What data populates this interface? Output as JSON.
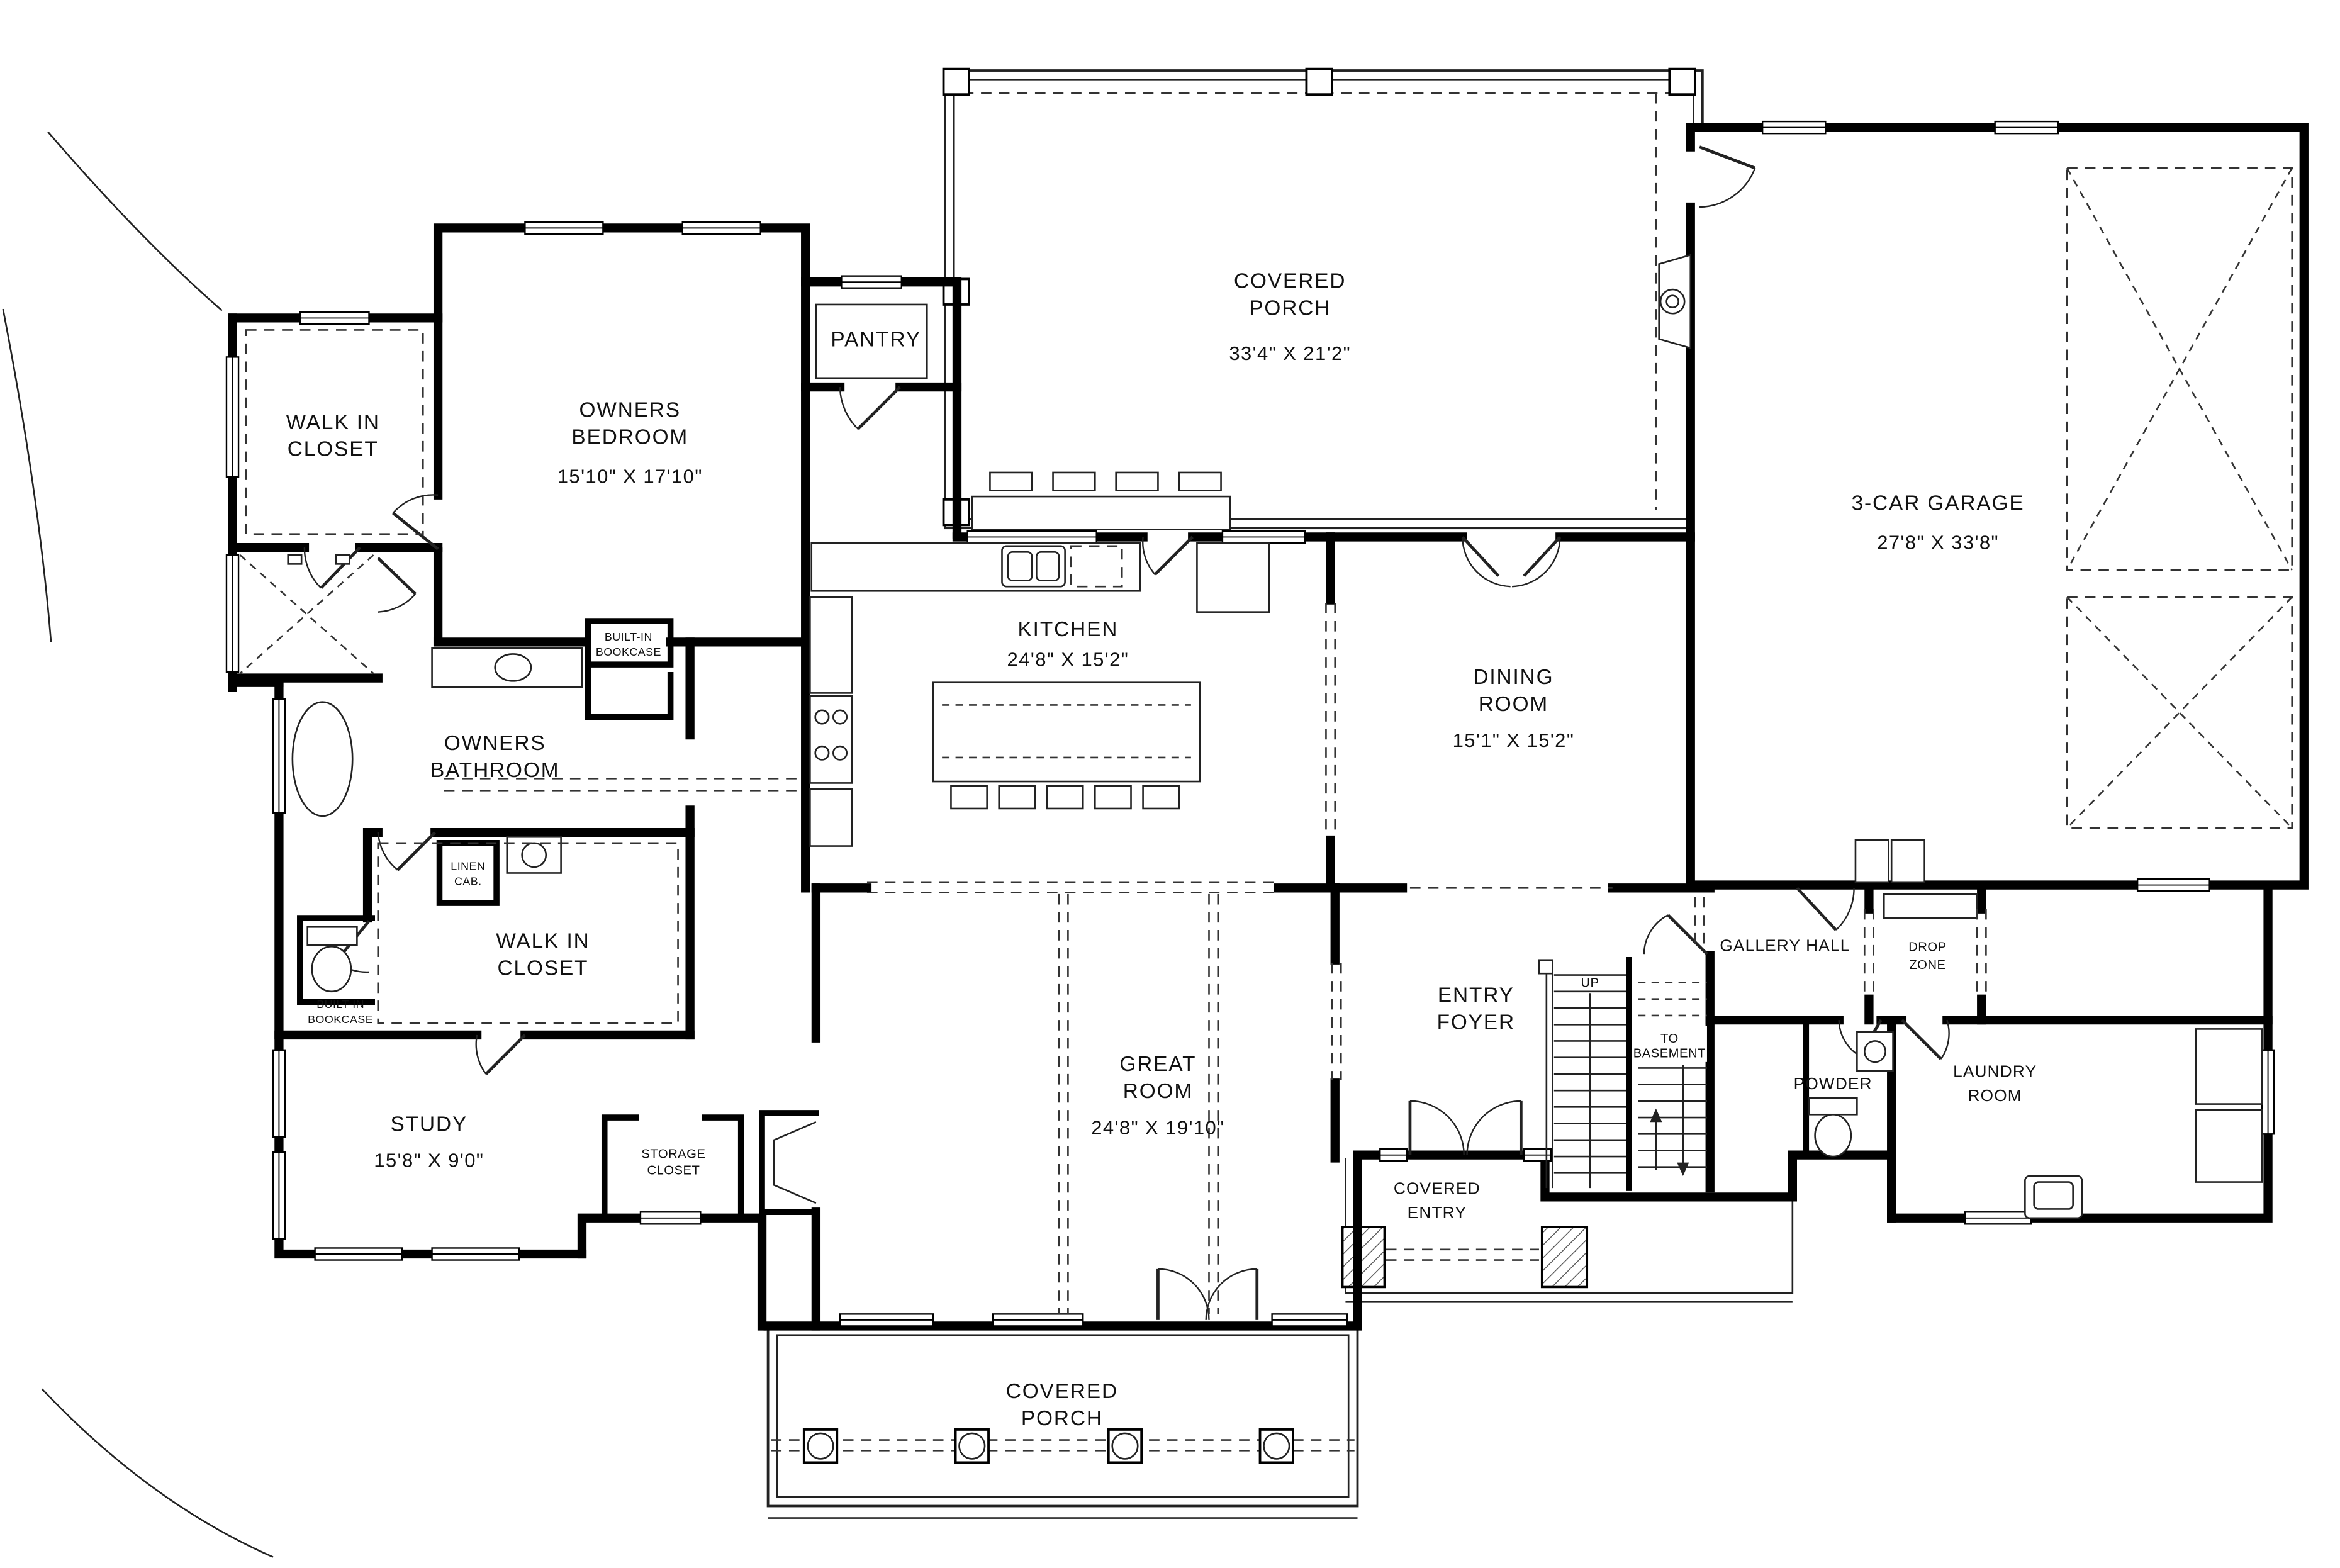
{
  "plan": {
    "rooms": {
      "covered_porch_top": {
        "line1": "COVERED",
        "line2": "PORCH",
        "dims": "33'4\" X 21'2\""
      },
      "garage": {
        "line1": "3-CAR GARAGE",
        "dims": "27'8\" X 33'8\""
      },
      "owners_bedroom": {
        "line1": "OWNERS",
        "line2": "BEDROOM",
        "dims": "15'10\" X 17'10\""
      },
      "walk_in_closet_1": {
        "line1": "WALK IN",
        "line2": "CLOSET"
      },
      "pantry": {
        "line1": "PANTRY"
      },
      "kitchen": {
        "line1": "KITCHEN",
        "dims": "24'8\" X 15'2\""
      },
      "dining_room": {
        "line1": "DINING",
        "line2": "ROOM",
        "dims": "15'1\" X 15'2\""
      },
      "owners_bathroom": {
        "line1": "OWNERS",
        "line2": "BATHROOM"
      },
      "built_in_bookcase_bath": {
        "line1": "BUILT-IN",
        "line2": "BOOKCASE"
      },
      "linen_cab": {
        "line1": "LINEN",
        "line2": "CAB."
      },
      "walk_in_closet_2": {
        "line1": "WALK IN",
        "line2": "CLOSET"
      },
      "built_in_bookcase_study": {
        "line1": "BUILT-IN",
        "line2": "BOOKCASE"
      },
      "study": {
        "line1": "STUDY",
        "dims": "15'8\" X 9'0\""
      },
      "storage_closet": {
        "line1": "STORAGE",
        "line2": "CLOSET"
      },
      "great_room": {
        "line1": "GREAT",
        "line2": "ROOM",
        "dims": "24'8\" X 19'10\""
      },
      "entry_foyer": {
        "line1": "ENTRY",
        "line2": "FOYER"
      },
      "gallery_hall": {
        "line1": "GALLERY HALL"
      },
      "drop_zone": {
        "line1": "DROP",
        "line2": "ZONE"
      },
      "powder": {
        "line1": "POWDER"
      },
      "laundry_room": {
        "line1": "LAUNDRY",
        "line2": "ROOM"
      },
      "covered_entry": {
        "line1": "COVERED",
        "line2": "ENTRY"
      },
      "covered_porch_bottom": {
        "line1": "COVERED",
        "line2": "PORCH"
      }
    },
    "stairs": {
      "up": "UP",
      "to_basement_line1": "TO",
      "to_basement_line2": "BASEMENT"
    },
    "colors": {
      "wall": "#000000",
      "background": "#ffffff",
      "linework": "#222222"
    }
  }
}
